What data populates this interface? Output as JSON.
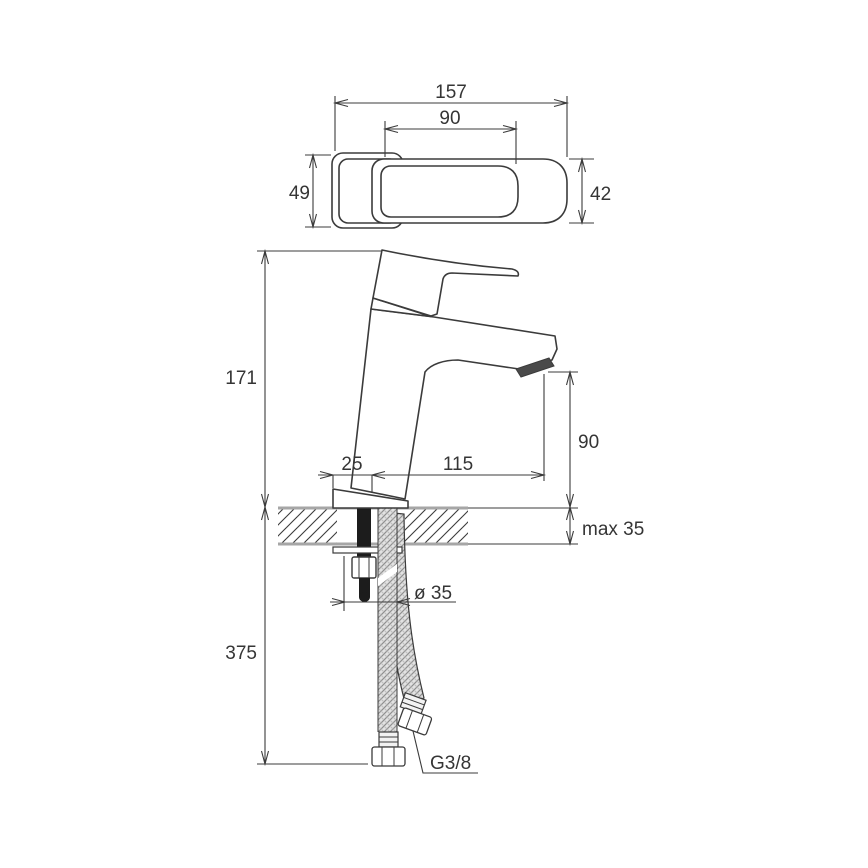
{
  "diagram": {
    "type": "technical-dimension-drawing",
    "subject": "Single-lever basin mixer faucet with flexible supply hoses - top view and side installation view",
    "units": "mm",
    "top_view": {
      "overall_length": "157",
      "lever_length": "90",
      "base_width": "49",
      "lever_width": "42"
    },
    "side_view": {
      "total_height": "171",
      "spout_outlet_height": "90",
      "spout_reach": "115",
      "base_front_offset": "25",
      "max_deck_thickness": "max 35",
      "hose_drop_length": "375",
      "mounting_hole_diameter": "ø 35",
      "hose_connection_thread": "G3/8"
    },
    "colors": {
      "line": "#3b3b3b",
      "counter_edge": "#a6a6a6",
      "background": "#ffffff"
    }
  }
}
